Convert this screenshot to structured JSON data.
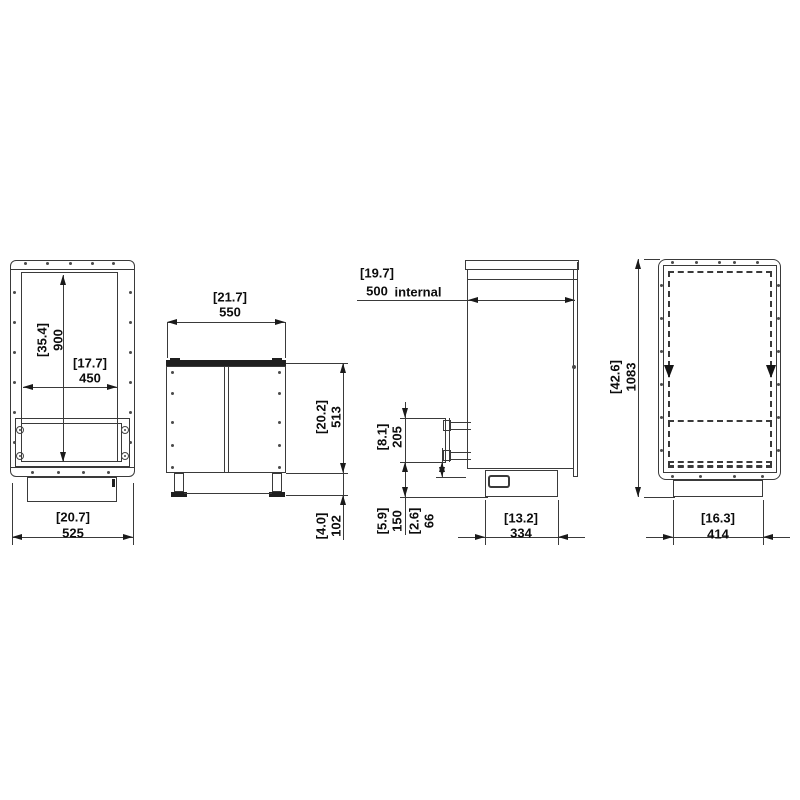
{
  "document": {
    "type": "technical-drawing-cabinet-4-views",
    "background_color": "#ffffff",
    "line_color": "#3a3a3a",
    "text_color": "#0d0d0d"
  },
  "views": {
    "front": {
      "dimensions": {
        "overall_height": {
          "inches": "[35.4]",
          "mm": "900"
        },
        "door_width": {
          "inches": "[17.7]",
          "mm": "450"
        },
        "overall_width": {
          "inches": "[20.7]",
          "mm": "525"
        }
      }
    },
    "front_doors": {
      "dimensions": {
        "overall_width": {
          "inches": "[21.7]",
          "mm": "550"
        },
        "body_height": {
          "inches": "[20.2]",
          "mm": "513"
        },
        "plinth_height": {
          "inches": "[4.0]",
          "mm": "102"
        }
      }
    },
    "side": {
      "dimensions": {
        "internal_depth": {
          "inches": "[19.7]",
          "mm": "500",
          "suffix": "internal"
        },
        "pipe_plate_span": {
          "inches": "[8.1]",
          "mm": "205"
        },
        "pipe_height": {
          "inches": "[5.9]",
          "mm": "150"
        },
        "connector_height": {
          "inches": "[2.6]",
          "mm": "66"
        },
        "base_depth": {
          "inches": "[13.2]",
          "mm": "334"
        }
      }
    },
    "rear": {
      "dimensions": {
        "overall_height": {
          "inches": "[42.6]",
          "mm": "1083"
        },
        "base_width": {
          "inches": "[16.3]",
          "mm": "414"
        }
      }
    }
  }
}
